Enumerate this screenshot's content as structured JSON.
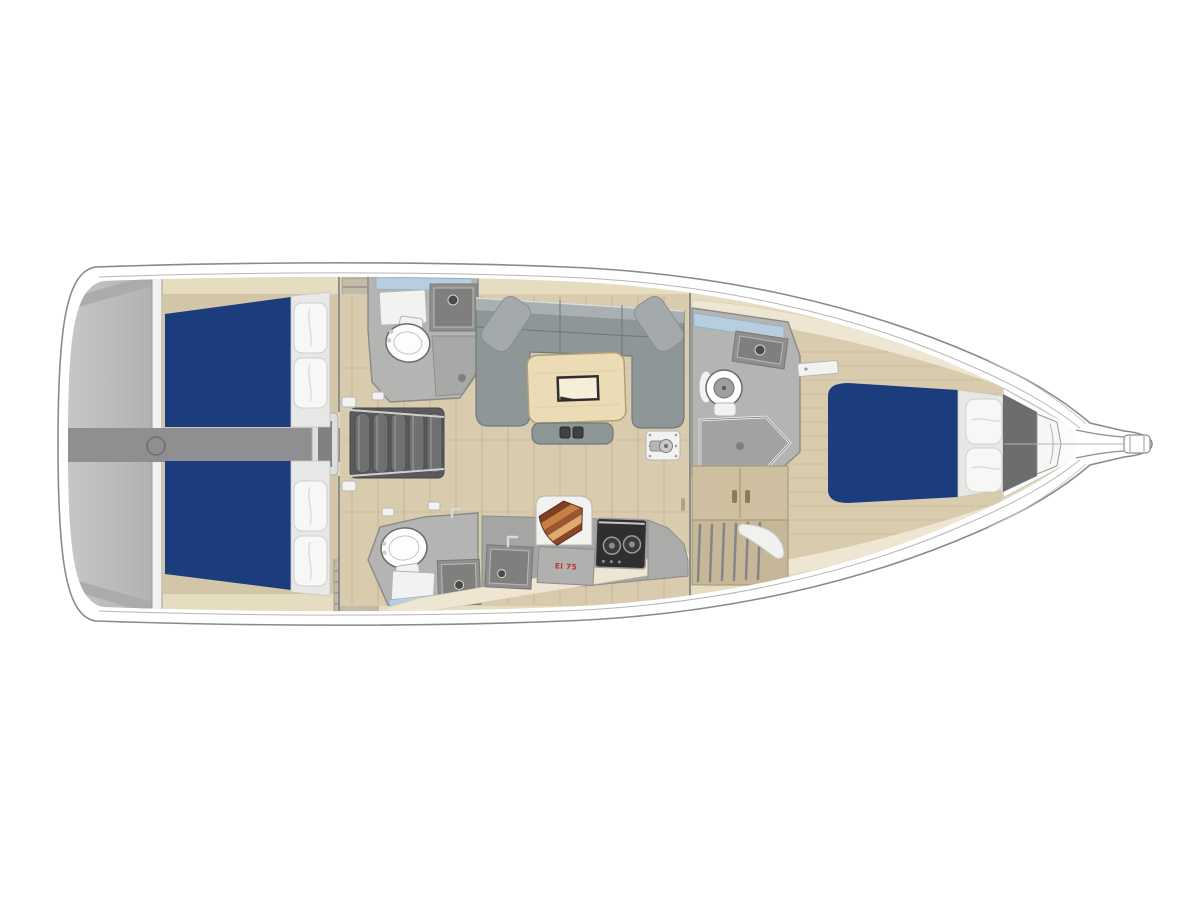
{
  "page": {
    "background": "#ffffff"
  },
  "plan": {
    "type": "yacht-interior-floor-plan",
    "view": "top-down",
    "bow_direction": "right",
    "stern_direction": "left",
    "areas": [
      {
        "id": "swim-platform",
        "desc": "stern transom swim platform"
      },
      {
        "id": "aft-cabin-port",
        "desc": "aft double cabin port with navy berth and two pillows"
      },
      {
        "id": "aft-cabin-starboard",
        "desc": "aft double cabin starboard with navy berth and two pillows"
      },
      {
        "id": "engine-corridor",
        "desc": "central passage between aft cabins"
      },
      {
        "id": "companionway-stairs",
        "desc": "companionway steps into salon"
      },
      {
        "id": "head-port",
        "desc": "port bathroom with toilet, sink and hatch"
      },
      {
        "id": "head-starboard",
        "desc": "starboard bathroom with toilet, sink and hatch"
      },
      {
        "id": "salon",
        "desc": "U-shaped sofa with folding table, bench and mast foot"
      },
      {
        "id": "galley",
        "desc": "galley with sink, two-burner stove, cutting board and fridge"
      },
      {
        "id": "head-forward",
        "desc": "forward bathroom with round toilet, sink and shower"
      },
      {
        "id": "forward-cabin",
        "desc": "forward cabin with island double berth, wardrobe and seat"
      },
      {
        "id": "bow-locker",
        "desc": "anchor locker and bowsprit"
      }
    ],
    "galley": {
      "fridge_label": "El 75"
    },
    "berth_count": 3,
    "head_count": 3,
    "pillow_count": 6
  },
  "colors": {
    "hull_outline": "#8a8a88",
    "transom_grey": "#c8c8ca",
    "corridor_grey": "#8f8f91",
    "bed_navy": "#1c3d7d",
    "pillow_white": "#f7f7f5",
    "floor_wood": "#d9cbad",
    "plank_line": "#c7b492",
    "floor_tan": "#d3c5a7",
    "shelf_beige": "#e6dcc0",
    "shelf_cream": "#eee6d2",
    "room_grey": "#b4b4b2",
    "fixture_grey": "#8f8f8d",
    "white_fixture": "#f2f2f0",
    "sofa_grey": "#8e9698",
    "sofa_back": "#aab0b2",
    "table_wood": "#ecdcb6",
    "glass_blue": "#b7d0e2",
    "stove_dark": "#2f2f31",
    "cabinet_wood": "#cdbf9f",
    "bulkhead_dark": "#6b6d6f",
    "board_1": "#7e3f24",
    "board_2": "#c8803f",
    "board_3": "#9c5530",
    "board_4": "#e0a96f",
    "board_5": "#8a4527",
    "label_red": "#c03030"
  }
}
